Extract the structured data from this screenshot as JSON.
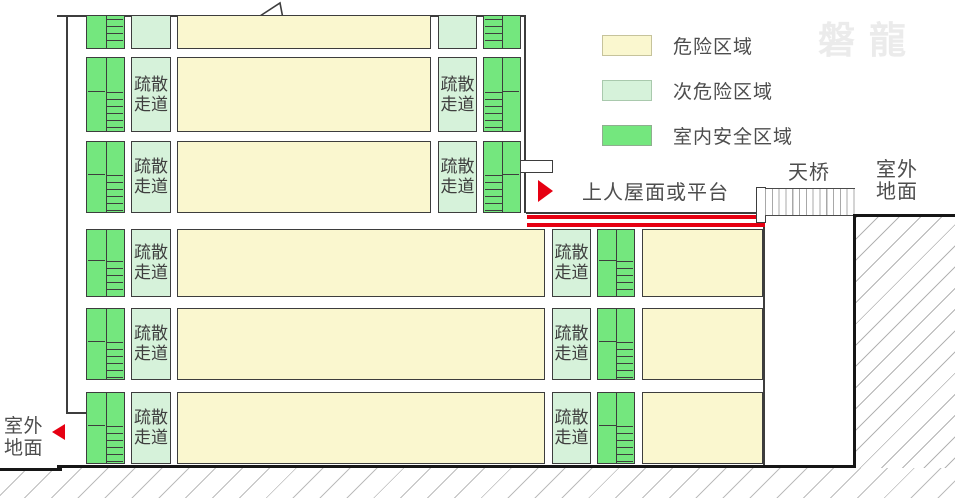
{
  "legend": {
    "items": [
      {
        "label": "危险区域",
        "color": "#FAF7CF"
      },
      {
        "label": "次危险区域",
        "color": "#D6F2DA"
      },
      {
        "label": "室内安全区域",
        "color": "#74E77E"
      }
    ]
  },
  "annotations": {
    "roof_platform": "上人屋面或平台",
    "sky_bridge": "天桥",
    "outdoor_ground_right": "室外地面",
    "outdoor_ground_left": "室外地面",
    "corridor_label": "疏散走道",
    "watermark": "磐龍"
  },
  "colors": {
    "danger_zone": "#FAF7CF",
    "secondary_danger_zone": "#D6F2DA",
    "indoor_safe_zone": "#74E77E",
    "highlight_red": "#E60012",
    "outline": "#3d3d3d"
  }
}
